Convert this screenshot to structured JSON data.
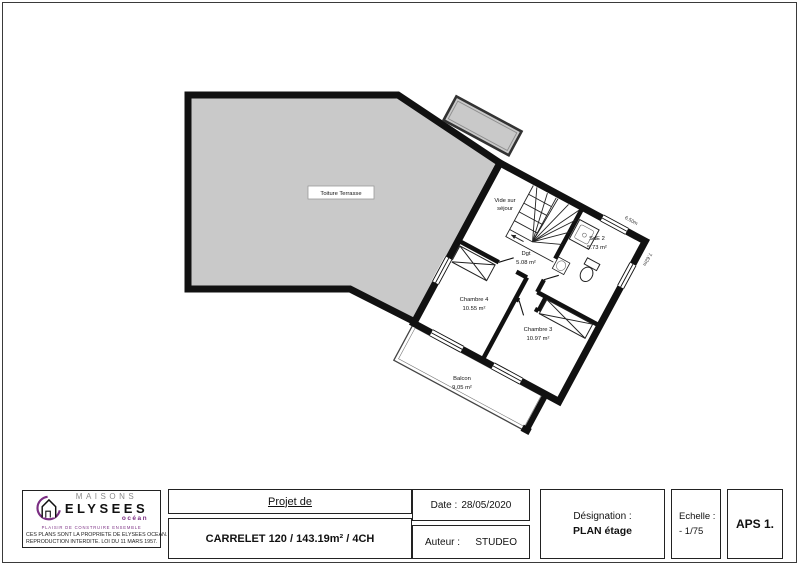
{
  "plan": {
    "terrace_label": "Toiture Terrasse",
    "rooms": {
      "vide": {
        "line1": "Vide sur",
        "line2": "séjour"
      },
      "dgt": {
        "name": "Dgt",
        "area": "5.08 m²"
      },
      "sde2": {
        "name": "SdE 2",
        "area": "5.73 m²"
      },
      "chambre4": {
        "name": "Chambre 4",
        "area": "10.55 m²"
      },
      "chambre3": {
        "name": "Chambre 3",
        "area": "10.97 m²"
      },
      "balcon": {
        "name": "Balcon",
        "area": "9.05 m²"
      }
    },
    "dimensions": {
      "ne_wall": "6.50m",
      "se_wall": "7.62m"
    },
    "colors": {
      "wall": "#111111",
      "terrace_fill": "#c9c9c9"
    }
  },
  "title_block": {
    "logo": {
      "brand_top": "MAISONS",
      "brand_main": "ELYSEES",
      "brand_sub": "océan",
      "slogan": "PLAISIR DE CONSTRUIRE ENSEMBLE",
      "fineprint_line1": "CES PLANS SONT LA PROPRIETE DE ELYSEES OCEAN.",
      "fineprint_line2": "REPRODUCTION INTERDITE. LOI DU 11 MARS 1957.",
      "brand_purple": "#7b2e83"
    },
    "project": {
      "label": "Projet de",
      "name": "CARRELET 120 / 143.19m² / 4CH"
    },
    "date": {
      "label": "Date :",
      "value": "28/05/2020"
    },
    "author": {
      "label": "Auteur :",
      "value": "STUDEO"
    },
    "designation": {
      "label": "Désignation :",
      "value": "PLAN étage"
    },
    "scale": {
      "label": "Echelle :",
      "value": "- 1/75"
    },
    "doc_ref": "APS 1."
  }
}
